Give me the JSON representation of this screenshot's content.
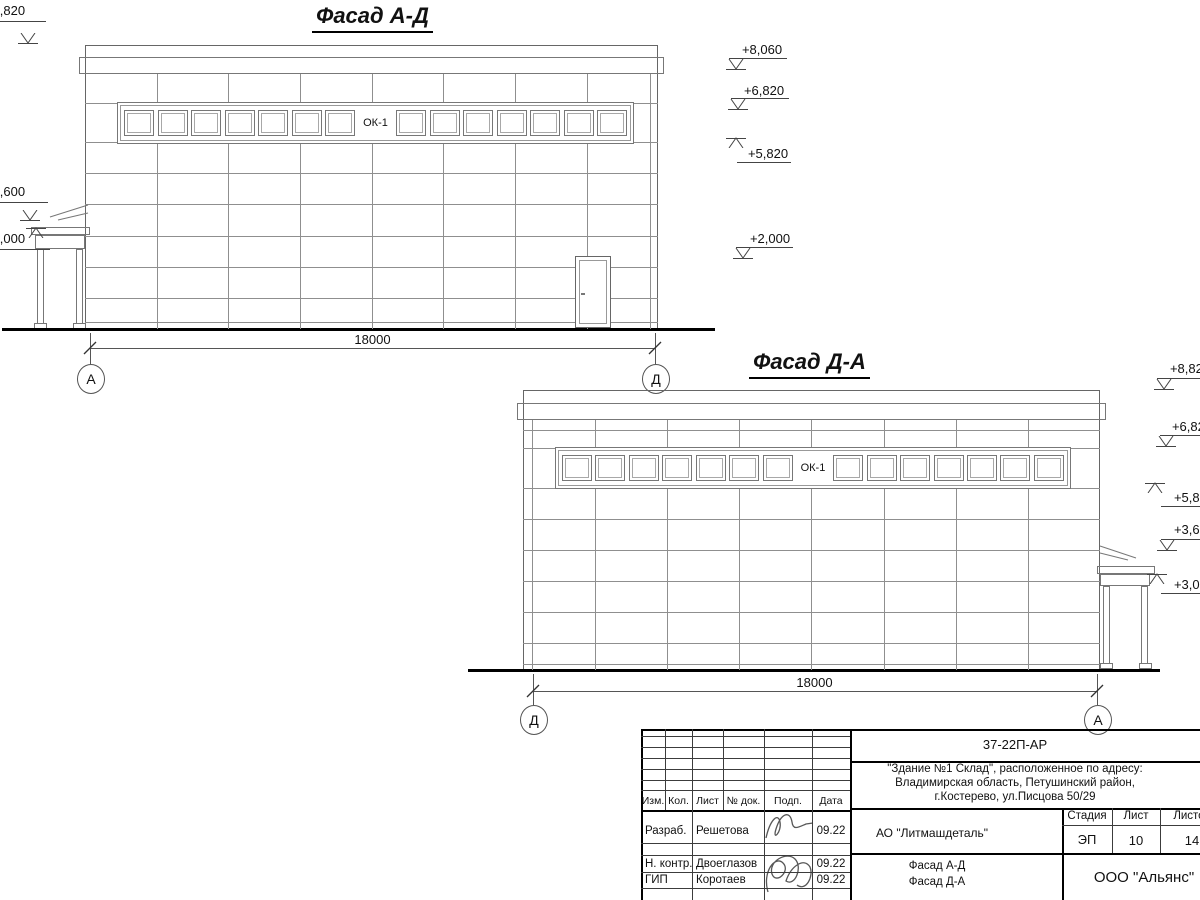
{
  "sheet": {
    "drawings": [
      {
        "title": "Фасад А-Д",
        "window_label": "ОК-1",
        "dimension": "18000",
        "axis_left": "А",
        "axis_right": "Д"
      },
      {
        "title": "Фасад Д-А",
        "window_label": "ОК-1",
        "dimension": "18000",
        "axis_left": "Д",
        "axis_right": "А"
      }
    ],
    "elevations": {
      "facade_ad_left": [
        "+8,820",
        "+3,600",
        "+3,000"
      ],
      "facade_ad_right": [
        "+8,060",
        "+6,820",
        "+5,820",
        "+2,000"
      ],
      "facade_da_right": [
        "+8,820",
        "+6,820",
        "+5,820",
        "+3,600",
        "+3,000"
      ]
    }
  },
  "title_block": {
    "document_number": "37-22П-АР",
    "project_lines": [
      "\"Здание №1 Склад\", расположенное по адресу:",
      "Владимирская область, Петушинский район,",
      "г.Костерево, ул.Писцова 50/29"
    ],
    "revision_headers": [
      "Изм.",
      "Кол.",
      "Лист",
      "№ док.",
      "Подп.",
      "Дата"
    ],
    "roles": [
      {
        "role": "Разраб.",
        "name": "Решетова",
        "date": "09.22"
      },
      {
        "role": "Н. контр.",
        "name": "Двоеглазов",
        "date": "09.22"
      },
      {
        "role": "ГИП",
        "name": "Коротаев",
        "date": "09.22"
      }
    ],
    "organization": "АО \"Литмашдеталь\"",
    "stage_label": "Стадия",
    "stage": "ЭП",
    "sheet_label": "Лист",
    "sheet": "10",
    "sheets_label": "Листов",
    "sheets": "14",
    "sheet_title_lines": [
      "Фасад А-Д",
      "Фасад Д-А"
    ],
    "company": "ООО \"Альянс\""
  }
}
